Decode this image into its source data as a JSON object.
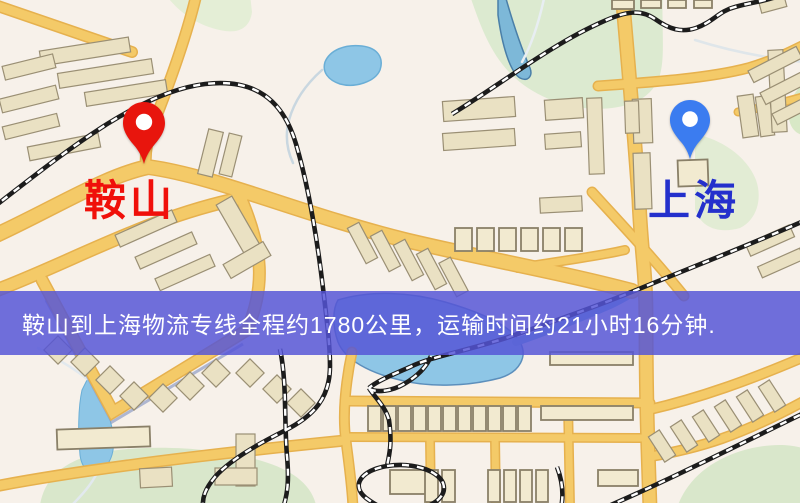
{
  "map_labels": {
    "origin": "鞍山",
    "destination": "上海"
  },
  "banner": {
    "text": "鞍山到上海物流专线全程约1780公里，运输时间约21小时16分钟."
  },
  "colors": {
    "banner_bg": "#5555d6",
    "origin_text": "#f0100a",
    "destination_text": "#2430cc",
    "origin_pin": "#e8150d",
    "destination_pin": "#3b7cf0",
    "road": "#f4ca68",
    "water": "#8ec6e6",
    "park": "#dcead0",
    "building": "#eae1c3",
    "railway": "#1c1c1c"
  },
  "icons": {
    "origin_pin": "map-pin-icon",
    "destination_pin": "map-pin-icon"
  }
}
